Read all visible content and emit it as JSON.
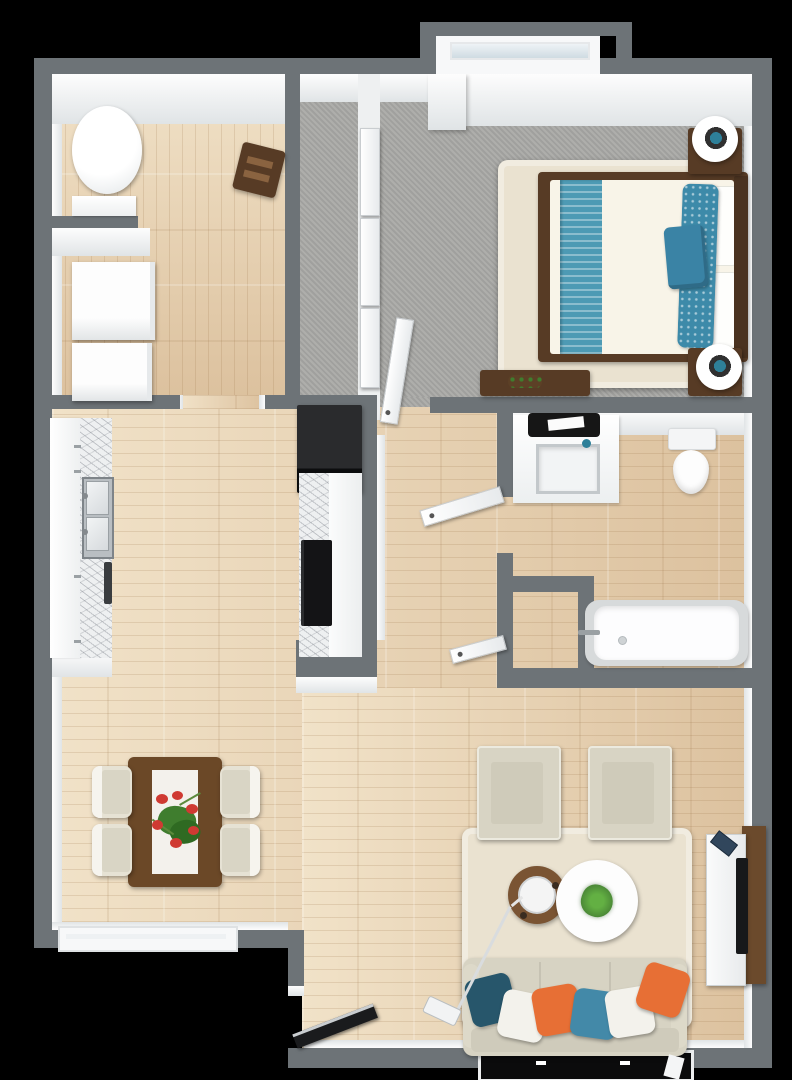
{
  "scene": {
    "type": "3d-floorplan-render",
    "view": "top-down bird's eye",
    "background": "#000000",
    "description": "One-bedroom apartment 3D floor plan: utility room, closet corridor, bedroom, bathroom with storage closet, open kitchen / dining / living area, entry door"
  },
  "palette": {
    "wall": "#6d7377",
    "wallFaceHi": "#fdfdfd",
    "wallFaceLo": "#e0e4e6",
    "wood": "#e8d3b4",
    "woodHi": "#f1e2c8",
    "woodLo": "#dcc19e",
    "carpet": "#a9a9a6",
    "rug": "#eae2d0",
    "brownDark": "#573b25",
    "brownMid": "#6b4827",
    "brownTv": "#6b4a2c",
    "tealRunner": "#4d9ab4",
    "tealPattern": "#3d8aa9",
    "tealAccent": "#3a83a5",
    "tealDark": "#27566b",
    "blue": "#4389a8",
    "orange": "#e76f35",
    "sofa": "#d7d3c3",
    "chairBeige": "#d8d4c4",
    "green": "#4c8a37",
    "greenBright": "#63b043",
    "red": "#cf3a32",
    "black": "#141416",
    "marbleBase": "#eef0f1",
    "metal": "#b9bec2",
    "lampTeal": "#2e8099"
  },
  "rooms": [
    {
      "name": "utility-room",
      "floor": "wood",
      "items": [
        "water-heater",
        "shelf",
        "washer",
        "dryer",
        "side-stool"
      ]
    },
    {
      "name": "closet-corridor",
      "floor": "carpet",
      "items": [
        "sliding-doors"
      ]
    },
    {
      "name": "bedroom",
      "floor": "carpet",
      "items": [
        "bay-window",
        "rug",
        "double-bed",
        "teal-runner",
        "pillows",
        "nightstand-x2",
        "sphere-lamp-x2",
        "dresser-with-plant",
        "door"
      ]
    },
    {
      "name": "bathroom",
      "floor": "wood",
      "items": [
        "vanity-sink",
        "mirror",
        "toilet",
        "bathtub",
        "storage-closet",
        "door"
      ]
    },
    {
      "name": "kitchen",
      "floor": "wood",
      "items": [
        "counter-with-double-sink",
        "fridge",
        "oven-cooktop",
        "marble-counters"
      ]
    },
    {
      "name": "dining-area",
      "floor": "wood",
      "items": [
        "table-with-runner",
        "flower-centerpiece",
        "chair-x4",
        "window"
      ]
    },
    {
      "name": "living-room",
      "floor": "wood",
      "items": [
        "rug",
        "armchair-x2",
        "round-coffee-table-brown",
        "kettle",
        "round-coffee-table-white",
        "plant",
        "sofa",
        "pillow-x6",
        "floor-lamp",
        "tv-console",
        "tv",
        "remote",
        "window",
        "entry-door"
      ]
    }
  ]
}
